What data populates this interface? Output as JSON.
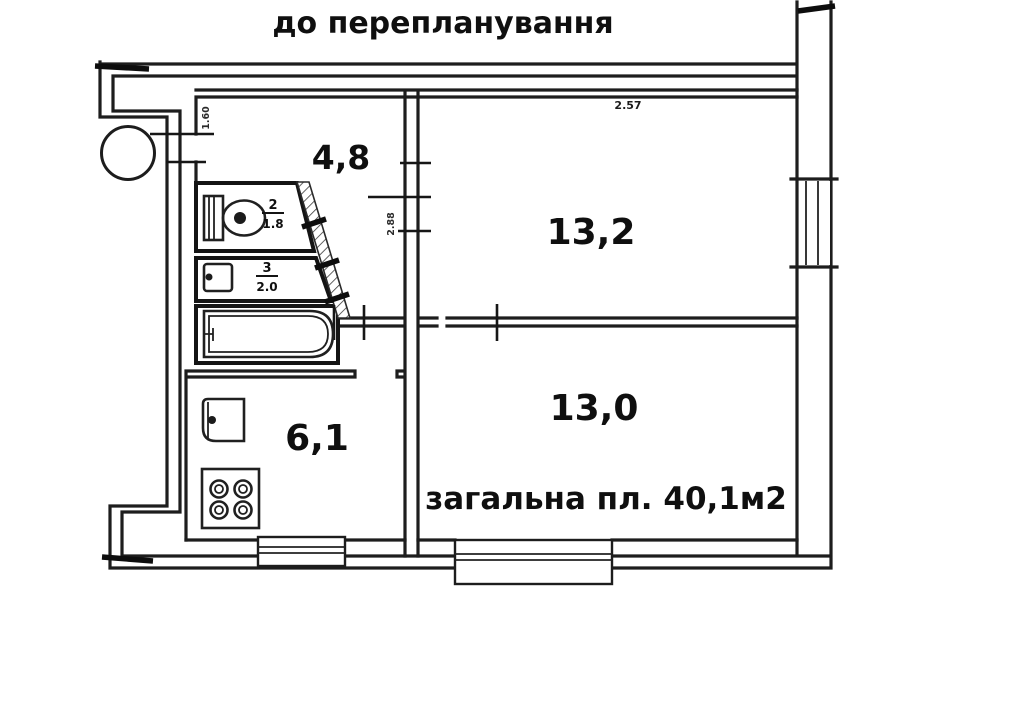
{
  "page": {
    "background": "#ffffff",
    "line_color": "#1d1d1d",
    "text_color": "#0f0f0f"
  },
  "title": "до перепланування",
  "plan": {
    "rooms": {
      "hall": {
        "area_label": "4,8"
      },
      "room_top": {
        "area_label": "13,2"
      },
      "room_bottom": {
        "area_label": "13,0"
      },
      "kitchen": {
        "area_label": "6,1"
      },
      "wc": {
        "number": "2",
        "area": "1.8"
      },
      "lavatory": {
        "number": "3",
        "area": "2.0"
      }
    },
    "total_area_label": "загальна пл. 40,1м2",
    "dimensions": {
      "top_width": "2.57",
      "left_height": "1.60",
      "hall_width": "2.88"
    },
    "fixtures": [
      "toilet-icon",
      "washbasin-icon",
      "bathtub-icon",
      "kitchen-sink-icon",
      "stove-icon",
      "ventilation-circle",
      "window-symbol"
    ]
  }
}
